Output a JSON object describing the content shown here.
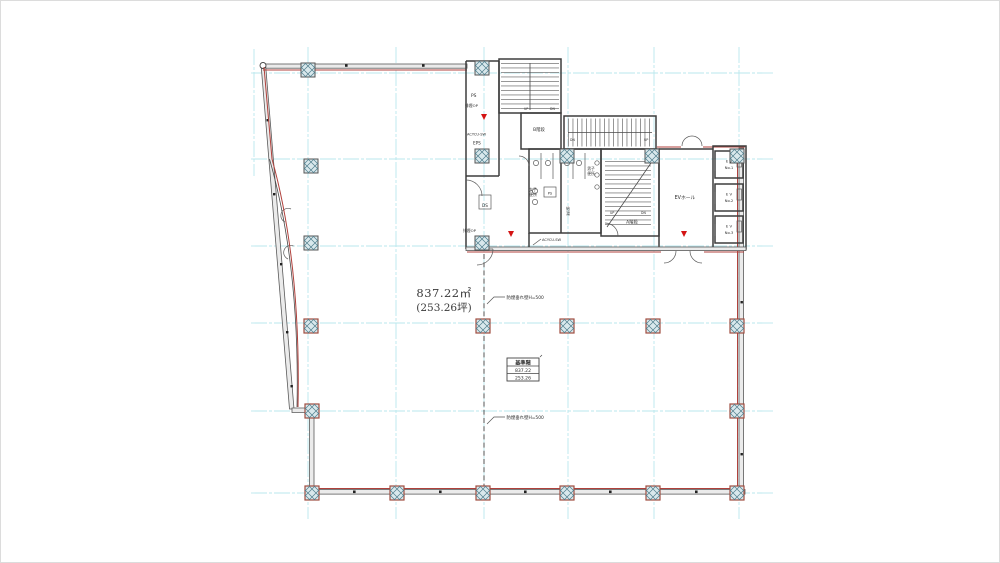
{
  "drawing": {
    "title": "基準階平面図",
    "area": {
      "m2": "837.22㎡",
      "tsubo": "(253.26坪)"
    },
    "annotations": {
      "smoke_barrier": "防煙垂れ壁H=500",
      "ac_switch": "ACYCU-SW"
    },
    "labels": {
      "ps_top": "PS",
      "smoke_vent_top": "排煙OP",
      "eps": "EPS",
      "ds": "DS",
      "smoke_vent_bottom": "排煙OP",
      "stair_b": "B階段",
      "stair_a": "A階段",
      "womens_l1": "女子",
      "womens_l2": "便所",
      "mens_l1": "男子",
      "mens_l2": "便所",
      "ps_small": "PS",
      "kyuto_l1": "給",
      "kyuto_l2": "湯",
      "ev_hall": "EVホール",
      "up": "UP",
      "dn": "DN"
    },
    "elevators": [
      {
        "l1": "E V",
        "l2": "No.1"
      },
      {
        "l1": "E V",
        "l2": "No.2"
      },
      {
        "l1": "E V",
        "l2": "No.3"
      }
    ],
    "stamp": {
      "header": "基準階",
      "row1": "837.22",
      "row2": "253.26"
    },
    "colors": {
      "paper": "#ffffff",
      "grid": "#b9e7ee",
      "wall": "#4a4a4a",
      "accent_red": "#b0413c",
      "marker_red": "#d41414",
      "column_hatch": "#4f7d8c",
      "column_border_a": "#555555",
      "column_border_b": "#a14d3f"
    }
  }
}
